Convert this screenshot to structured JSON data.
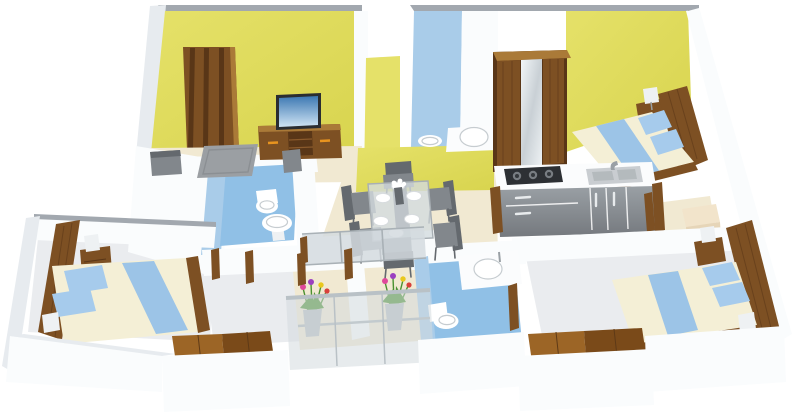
{
  "meta": {
    "title": "3D isometric floor plan render of a 3-bedroom apartment",
    "view": "top-down 3D cutaway floor plan",
    "background": "#ffffff",
    "visible_text": ""
  },
  "colors": {
    "bg": "#ffffff",
    "wallWhite": "#fafcfd",
    "wallShade": "#e7ebef",
    "wallShade2": "#d9dee3",
    "wallCap": "#a2a8af",
    "yellow": "#d8d44e",
    "yellowLight": "#e5e169",
    "bathWallBlue": "#a9cce9",
    "bathFloorBlue": "#90c0e6",
    "floorBeige": "#f1e9d2",
    "floorGray": "#eaecef",
    "floorGrayDark": "#d9dce0",
    "wood": "#7d5023",
    "woodLight": "#aa7a38",
    "woodDark": "#593617",
    "woodFloorA": "#9c6526",
    "woodFloorB": "#7a4a19",
    "gray": "#82878c",
    "grayDark": "#64696e",
    "rug": "#9b9fa3",
    "mattress": "#f4efd6",
    "runner": "#9cc4e7",
    "pillow": "#a6cbec",
    "steel": "#c9cdd1",
    "stove": "#2d3034",
    "counter": "#fbfcfd",
    "cabinet": "#909499",
    "cabinetDark": "#6f7378",
    "glass": "#d3dbdf",
    "tvFrame": "#2a2d31",
    "tvSkyTop": "#3c78b2",
    "tvSkyBottom": "#cfe4f4",
    "orange": "#e8941f",
    "green": "#4a9130",
    "pink": "#e0489b",
    "flowerYellow": "#e9c81e",
    "purple": "#9b3fc0",
    "red": "#d8403a",
    "lamp": "#eef1f3"
  },
  "scene": {
    "rooms": [
      {
        "name": "living room",
        "wall": "yellow",
        "floor": "beige",
        "furniture": [
          "wooden entry door",
          "tv unit",
          "flat screen tv",
          "sofa",
          "armchair",
          "grey area rug"
        ]
      },
      {
        "name": "dining area",
        "floor": "beige",
        "furniture": [
          "glass dining table",
          "6 grey chairs",
          "6 white plates",
          "flower centerpiece"
        ]
      },
      {
        "name": "kitchen",
        "furniture": [
          "white countertop",
          "3-burner gas hob",
          "double-bowl sink with faucet",
          "grey base cabinets with drawers"
        ]
      },
      {
        "name": "bedroom top right",
        "wall": "yellow",
        "furniture": [
          "double bed with blue runner",
          "2 blue pillows",
          "wooden headboard",
          "bedside table",
          "table lamp",
          "mirrored wooden wardrobe"
        ]
      },
      {
        "name": "bathroom top centre",
        "wall": "blue",
        "furniture": [
          "counter washbasin",
          "toilet"
        ]
      },
      {
        "name": "bathroom centre left",
        "wall": "blue",
        "furniture": [
          "toilet",
          "pedestal washbasin"
        ]
      },
      {
        "name": "bedroom bottom left",
        "furniture": [
          "double bed with blue runner",
          "2 blue pillows",
          "wooden headboard",
          "bedside table",
          "2 table lamps"
        ]
      },
      {
        "name": "bathroom bottom centre",
        "wall": "blue",
        "furniture": [
          "counter washbasin",
          "toilet"
        ]
      },
      {
        "name": "bedroom bottom right",
        "furniture": [
          "double bed with blue runner",
          "2 blue pillows",
          "wooden headboard",
          "bedside table",
          "2 table lamps"
        ]
      },
      {
        "name": "balcony",
        "furniture": [
          "glass railing",
          "2 flower planters with pink, yellow, purple and red flowers"
        ]
      },
      {
        "name": "utility nook",
        "furniture": [
          "cream storage ottoman"
        ]
      },
      {
        "name": "foyer landings",
        "furniture": [
          "wooden deck flooring"
        ]
      }
    ]
  }
}
